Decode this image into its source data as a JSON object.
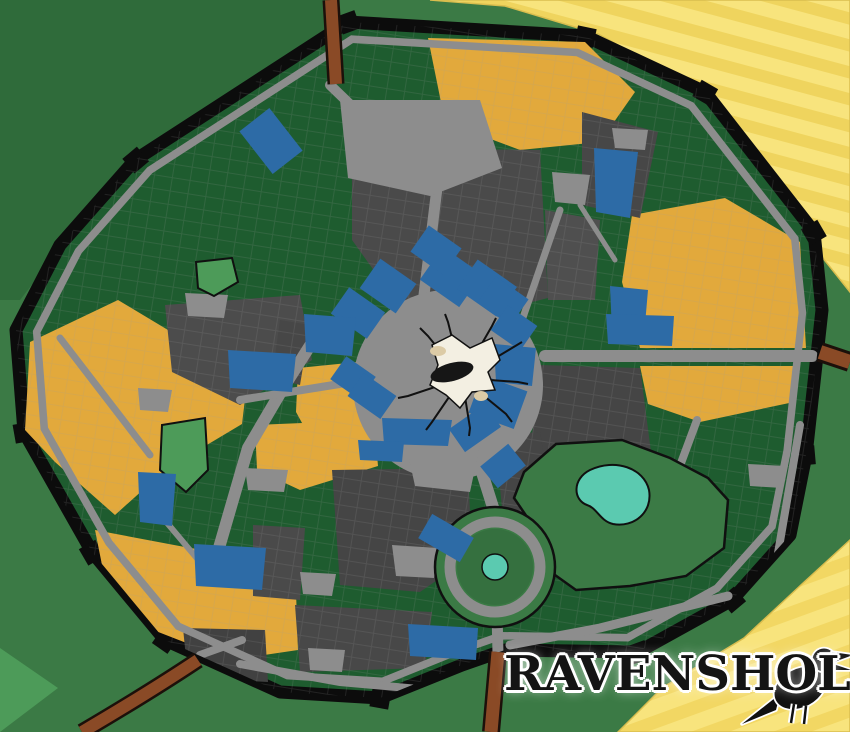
{
  "title": {
    "text": "RAVENSHOLM"
  },
  "colors": {
    "exterior_green": "#3b7a45",
    "district_green": "#1e5c2f",
    "district_gray": "#4a4a4a",
    "district_gray_dark": "#414141",
    "district_gold": "#e2a93c",
    "building_blue": "#2d6ba6",
    "road_gray": "#8d8d8d",
    "wall_black": "#0c0c0c",
    "farmland_yellow": "#f8e47d",
    "farmland_stripe": "#efd45e",
    "outer_road_brown": "#8a4a26",
    "lake_teal": "#5bcab0",
    "park_bright": "#4d9b59"
  },
  "map": {
    "labels": {
      "streets": [
        {
          "id": "crawfords-run",
          "text": "CRAWFORD'S RUN",
          "x": 100,
          "y": 241,
          "r": -38,
          "cls": "wl s1"
        },
        {
          "id": "the-bloody-gate",
          "text": "THE BLOODY GATE",
          "x": 311,
          "y": 86,
          "r": -22,
          "cls": "wl s1"
        },
        {
          "id": "guard-post-north",
          "text": "GUARD POST",
          "x": 345,
          "y": 95,
          "r": -22,
          "cls": "wl s2"
        },
        {
          "id": "lexx-avenue",
          "text": "LEXX AVENUE",
          "x": 628,
          "y": 76,
          "r": 24,
          "cls": "wl s2"
        },
        {
          "id": "perkins-place",
          "text": "PERKINS PLACE",
          "x": 412,
          "y": 230,
          "r": 78,
          "cls": "d s3"
        },
        {
          "id": "parris-street",
          "text": "PARRIS STREET",
          "x": 223,
          "y": 464,
          "r": -58,
          "cls": "d s3"
        },
        {
          "id": "auld-reenie",
          "text": "AULD REENIE",
          "x": 93,
          "y": 374,
          "r": 51,
          "cls": "d s2"
        },
        {
          "id": "barrett-walk",
          "text": "BARRETT WALK",
          "x": 104,
          "y": 560,
          "r": 59,
          "cls": "wl s1"
        },
        {
          "id": "echovale-wynd",
          "text": "ECHOVALE WYND",
          "x": 168,
          "y": 556,
          "r": 52,
          "cls": "d s0"
        },
        {
          "id": "mercers-way",
          "text": "MERCER'S WAY",
          "x": 476,
          "y": 458,
          "r": 58,
          "cls": "d s3"
        },
        {
          "id": "minscan-boulevard",
          "text": "MINSCAN BOULEVARD",
          "x": 672,
          "y": 355,
          "r": 0,
          "cls": "d s3"
        },
        {
          "id": "street-road",
          "text": "STREET ROAD",
          "x": 701,
          "y": 456,
          "r": -55,
          "cls": "d s1"
        },
        {
          "id": "mcneil-lane",
          "text": "MCNEIL LANE",
          "x": 789,
          "y": 508,
          "r": 95,
          "cls": "d s2"
        },
        {
          "id": "claytons-gate",
          "text": "CLAYTON'S GATE",
          "x": 810,
          "y": 341,
          "r": 70,
          "cls": "wl s1"
        },
        {
          "id": "the-coin-gate",
          "text": "THE COIN GATE",
          "x": 172,
          "y": 668,
          "r": 47,
          "cls": "wl s1"
        },
        {
          "id": "snazby-road",
          "text": "SNAZBY ROAD",
          "x": 139,
          "y": 703,
          "r": -48,
          "cls": "br s1"
        },
        {
          "id": "the-north-gate",
          "text": "THE NORTH GATE",
          "x": 499,
          "y": 647,
          "r": -8,
          "cls": "wl s1"
        },
        {
          "id": "arneson-road",
          "text": "ARNESON ROAD",
          "x": 574,
          "y": 630,
          "r": -9,
          "cls": "d s1"
        },
        {
          "id": "dunican-street",
          "text": "DUNICAN STREET",
          "x": 371,
          "y": 693,
          "r": -32,
          "cls": "d s1"
        },
        {
          "id": "phoenix-circle",
          "text": "PHOENIX CIRCLE",
          "x": 498,
          "y": 529,
          "r": 8,
          "cls": "d s2"
        },
        {
          "id": "guffmans-wait",
          "text": "GUFFMAN'S\nWAIT",
          "x": 470,
          "y": 240,
          "r": -55,
          "cls": "w s0"
        }
      ],
      "squares": [
        {
          "id": "gygax-court",
          "text": "GYGAX\nCOURT",
          "x": 335,
          "y": 137,
          "r": 0,
          "cls": "d s3"
        },
        {
          "id": "trias-square",
          "text": "TRIAS\nSQUARE",
          "x": 630,
          "y": 140,
          "r": 0,
          "cls": "d s1"
        },
        {
          "id": "echo-plaza-ne",
          "text": "ECHO\nPLAZA",
          "x": 569,
          "y": 190,
          "r": 0,
          "cls": "d s1"
        },
        {
          "id": "salvatore-square",
          "text": "SALVATORE\nSQUARE",
          "x": 206,
          "y": 307,
          "r": 0,
          "cls": "d s1"
        },
        {
          "id": "echo-plaza-west",
          "text": "ECHO\nPLAZA",
          "x": 155,
          "y": 400,
          "r": 0,
          "cls": "d s1"
        },
        {
          "id": "novellie-square",
          "text": "NOVELLIE\nSQUARE",
          "x": 649,
          "y": 397,
          "r": 0,
          "cls": "d s1"
        },
        {
          "id": "echo-plaza-se",
          "text": "ECHO\nPLAZA",
          "x": 656,
          "y": 459,
          "r": 0,
          "cls": "d s1"
        },
        {
          "id": "annah-square",
          "text": "ANNAH\nSQUARE",
          "x": 265,
          "y": 481,
          "r": 0,
          "cls": "d s1"
        },
        {
          "id": "duff-court",
          "text": "DUFF\nCOURT",
          "x": 317,
          "y": 585,
          "r": 0,
          "cls": "d s1"
        },
        {
          "id": "vhailor-place",
          "text": "VHAILOR\nPLACE",
          "x": 326,
          "y": 661,
          "r": 0,
          "cls": "d s1"
        },
        {
          "id": "vo-place",
          "text": "VO\nPLACE",
          "x": 766,
          "y": 477,
          "r": 0,
          "cls": "d s1"
        },
        {
          "id": "tuck-circus",
          "text": "TUCK\nCIRCUS",
          "x": 415,
          "y": 561,
          "r": 0,
          "cls": "d s1"
        },
        {
          "id": "monarchs-square",
          "text": "MONARCH'S\nSQUARE",
          "x": 434,
          "y": 396,
          "r": 0,
          "cls": "d s4"
        },
        {
          "id": "brigstocke-park",
          "text": "BRIGSTOCKE\nPARK",
          "x": 583,
          "y": 538,
          "r": 0,
          "cls": "d s4"
        }
      ],
      "parks": [
        {
          "id": "morte-park",
          "text": "MORTE\nPARK",
          "x": 184,
          "y": 458,
          "r": 0,
          "cls": "w s1"
        },
        {
          "id": "mark-mere",
          "text": "MARK\nMERE",
          "x": 601,
          "y": 492,
          "r": 0,
          "cls": "w s1"
        },
        {
          "id": "the-reeds",
          "text": "THE\nREEDS",
          "x": 497,
          "y": 547,
          "r": 0,
          "cls": "w s1"
        },
        {
          "id": "graveyard",
          "text": "GRAVEYARD",
          "x": 596,
          "y": 617,
          "r": 0,
          "cls": "w s1"
        },
        {
          "id": "temple-five-faiths",
          "text": "TEMPLE OF\nTHE FIVE FAITHS",
          "x": 631,
          "y": 590,
          "r": 0,
          "cls": "w s1"
        },
        {
          "id": "the-really-big-tree",
          "text": "THE REALLY BIG TREE",
          "x": 219,
          "y": 277,
          "r": 0,
          "cls": "w s1"
        },
        {
          "id": "sinkhole",
          "text": "SINKHOLE",
          "x": 445,
          "y": 341,
          "r": 0,
          "cls": "sink"
        }
      ],
      "civic": [
        {
          "id": "guardhouse",
          "text": "GUARDHOUSE",
          "x": 227,
          "y": 667,
          "r": 0,
          "cls": "w s2"
        },
        {
          "id": "guard-post-east",
          "text": "GUARD\nPOST",
          "x": 804,
          "y": 382,
          "r": 0,
          "cls": "w s1"
        },
        {
          "id": "guard-post-south",
          "text": "GUARD\nPOST",
          "x": 484,
          "y": 636,
          "r": 0,
          "cls": "w s1"
        },
        {
          "id": "ravensholm-library",
          "text": "RAVENSHOLM\nLIBRARY",
          "x": 315,
          "y": 205,
          "r": 0,
          "cls": "w s2"
        },
        {
          "id": "stables",
          "text": "STABLES",
          "x": 381,
          "y": 452,
          "r": 0,
          "cls": "w s1"
        }
      ],
      "pois": [
        {
          "id": "korgans-discount-meat",
          "text": "KORGAN'S\nDISCOUNT MEAT\nAND GAME",
          "x": 271,
          "y": 141,
          "r": -38,
          "cls": "w s0"
        },
        {
          "id": "cogbottoms-petting-zoo",
          "text": "COGBOTTOM'S\nMONSTROUS\nPETTING ZOO\n& ACTIVITY CENTRE",
          "x": 389,
          "y": 143,
          "r": 0,
          "cls": "w s1"
        },
        {
          "id": "mushkins-florists",
          "text": "MUSHKIN'S\nSKID ROW\nFLORISTS",
          "x": 420,
          "y": 180,
          "r": -10,
          "cls": "w s1"
        },
        {
          "id": "whitters-museum",
          "text": "THE\nWHITTERS\nMUSEUM",
          "x": 611,
          "y": 169,
          "r": 0,
          "cls": "w s1"
        },
        {
          "id": "largos-herbalism",
          "text": "LARGO'S\nHERBALISM",
          "x": 622,
          "y": 282,
          "r": 0,
          "cls": "w s1"
        },
        {
          "id": "toolshed-general-store",
          "text": "THE TOOLSHED\nGENERAL STORE",
          "x": 641,
          "y": 331,
          "r": 0,
          "cls": "w s1"
        },
        {
          "id": "butterworth-farms",
          "text": "BUTTERWORTH\nFARMS",
          "x": 776,
          "y": 341,
          "r": 0,
          "cls": "w s1"
        },
        {
          "id": "lorem-ipsum-printers",
          "text": "LOREM IPSUM\nPRINTERS",
          "x": 436,
          "y": 250,
          "r": -55,
          "cls": "w s0"
        },
        {
          "id": "ironstone-garments",
          "text": "IRONSTONE\nGARMENTS",
          "x": 388,
          "y": 286,
          "r": -55,
          "cls": "w s0"
        },
        {
          "id": "phoenix-bar-theatre",
          "text": "THE PHOENIX\nBAR & THEATRE",
          "x": 452,
          "y": 277,
          "r": -55,
          "cls": "w s0"
        },
        {
          "id": "helmich-lunter",
          "text": "HELMICH &\nLUNTER\nCONSTRUCTION",
          "x": 488,
          "y": 288,
          "r": -55,
          "cls": "w s0"
        },
        {
          "id": "waddicks-launderer",
          "text": "WADDICK'S\nLAUNDERER",
          "x": 501,
          "y": 303,
          "r": -55,
          "cls": "w s0"
        },
        {
          "id": "finlays-coster",
          "text": "FINLAY'S\nCOSTER",
          "x": 514,
          "y": 328,
          "r": -55,
          "cls": "w s0"
        },
        {
          "id": "kragnars-apocathary",
          "text": "KRAGNAR'S\nAPOCATHARY",
          "x": 358,
          "y": 313,
          "r": -55,
          "cls": "w s0"
        },
        {
          "id": "the-dran-bank",
          "text": "THE\nDRAN\nBANK",
          "x": 330,
          "y": 335,
          "r": 0,
          "cls": "w s1"
        },
        {
          "id": "mioso-patisserie",
          "text": "MIOSO\nPATISSERIE",
          "x": 296,
          "y": 354,
          "r": 58,
          "cls": "w s0"
        },
        {
          "id": "the-sad-birthday",
          "text": "THE SAD\nBIRTHDAY",
          "x": 262,
          "y": 371,
          "r": 0,
          "cls": "w s1"
        },
        {
          "id": "copperhand-miners-guild",
          "text": "COPPERHAND\nMINER'S GUILD",
          "x": 316,
          "y": 391,
          "r": -55,
          "cls": "w s0"
        },
        {
          "id": "advocates-office",
          "text": "ADVOCATE'S\nOFFICE",
          "x": 354,
          "y": 378,
          "r": -55,
          "cls": "w s0"
        },
        {
          "id": "lenics-freight",
          "text": "LENIC'S\nFREIGHT &\nHAULAGE",
          "x": 372,
          "y": 396,
          "r": -55,
          "cls": "w s0"
        },
        {
          "id": "the-warm-chameleon",
          "text": "THE WARM\nCHAMELEON",
          "x": 415,
          "y": 431,
          "r": 0,
          "cls": "w s1"
        },
        {
          "id": "the-corner-cafe",
          "text": "THE\nCORNER\nCAFE",
          "x": 510,
          "y": 364,
          "r": 0,
          "cls": "w s1"
        },
        {
          "id": "town-hall",
          "text": "TOWN\nHALL",
          "x": 509,
          "y": 400,
          "r": -80,
          "cls": "w s0"
        },
        {
          "id": "red-mist-butchers",
          "text": "RED MIST\nBUTCHERS",
          "x": 489,
          "y": 401,
          "r": -60,
          "cls": "w s0"
        },
        {
          "id": "manganiellos",
          "text": "MANGANIELLO'S",
          "x": 475,
          "y": 428,
          "r": 55,
          "cls": "w s0"
        },
        {
          "id": "sampsons-gallery",
          "text": "SAMPSON'S\nGALLERY",
          "x": 503,
          "y": 466,
          "r": 51,
          "cls": "w s0"
        },
        {
          "id": "the-black-apiary",
          "text": "THE BLACK\nAPIARY",
          "x": 323,
          "y": 456,
          "r": 0,
          "cls": "w s1"
        },
        {
          "id": "battlebridge-club",
          "text": "THE\nBATTLEBRIDGE\nCLUB",
          "x": 446,
          "y": 539,
          "r": -60,
          "cls": "w s0"
        },
        {
          "id": "echovales-candy-funeral",
          "text": "ECHOVALE'S\nCANDY STORE\n&\nFUNERAL HOME",
          "x": 158,
          "y": 499,
          "r": 0,
          "cls": "w s1"
        },
        {
          "id": "resoloute-benhams-smithy",
          "text": "RESOLOUTE\nBENHAM'S\nSMITHY",
          "x": 228,
          "y": 571,
          "r": 0,
          "cls": "w s1"
        },
        {
          "id": "the-rothfuss-market",
          "text": "THE ROTHFUSS\nMARKET",
          "x": 444,
          "y": 643,
          "r": 0,
          "cls": "w s1"
        }
      ]
    }
  }
}
